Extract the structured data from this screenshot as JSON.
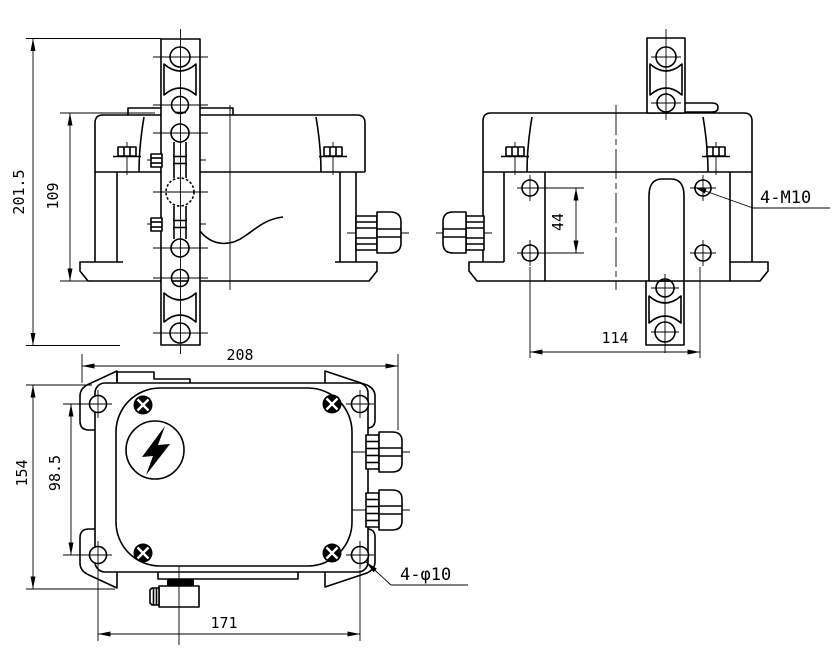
{
  "title": "engineering-drawing-limit-switch",
  "colors": {
    "background": "#ffffff",
    "line": "#000000"
  },
  "views": {
    "front": {
      "dims": {
        "overall_height": "201.5",
        "body_height": "109"
      }
    },
    "side": {
      "dims": {
        "hole_spacing_vertical": "44",
        "hole_spacing_horizontal": "114"
      },
      "callouts": {
        "mounting_thread": "4-M10"
      }
    },
    "plan": {
      "dims": {
        "overall_width": "208",
        "overall_depth": "154",
        "hole_spacing_vertical": "98.5",
        "hole_spacing_horizontal": "171"
      },
      "callouts": {
        "mounting_hole": "4-φ10"
      },
      "symbols": {
        "high_voltage": "lightning-bolt"
      }
    }
  }
}
